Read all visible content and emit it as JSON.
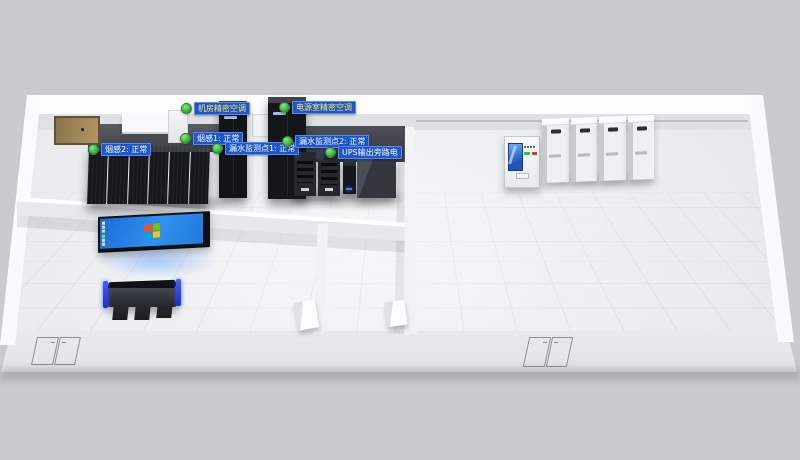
{
  "scene": {
    "type": "3d-machine-room-monitoring-view"
  },
  "status_labels": [
    {
      "id": "ac-machine-room",
      "text": "机房精密空调",
      "state_icon": "green-dot",
      "text_color": "#ffe94d"
    },
    {
      "id": "ac-power-room",
      "text": "电源室精密空调",
      "state_icon": "green-dot",
      "text_color": "#ffe94d"
    },
    {
      "id": "smoke-sensor-2",
      "text": "烟感2: 正常",
      "state_icon": "green-dot",
      "text_color": "#ffffff"
    },
    {
      "id": "smoke-sensor-1",
      "text": "烟感1: 正常",
      "state_icon": "green-dot",
      "text_color": "#ffffff"
    },
    {
      "id": "leak-point-1",
      "text": "漏水监测点1: 正常",
      "state_icon": "green-dot",
      "text_color": "#ffffff"
    },
    {
      "id": "leak-point-2",
      "text": "漏水监测点2: 正常",
      "state_icon": "green-dot",
      "text_color": "#ffffff"
    },
    {
      "id": "ups-output",
      "text": "UPS输出旁路电",
      "state_icon": "green-dot",
      "text_color": "#ffffff"
    }
  ],
  "icons": {
    "status_dot": "green-circle-normal",
    "windows_logo": "four-color-flag"
  },
  "palette": {
    "label_background": "#1d56cf",
    "label_border": "#5d8ce8",
    "status_green": "#2ca23c",
    "screen_blue": "#2f93ee",
    "console_accent_blue": "#1d2bd8",
    "monitor_screen_blue": "#1d55b8",
    "floor": "#eef0f2",
    "background": "#c9cbcc",
    "rack_black": "#16181c"
  }
}
